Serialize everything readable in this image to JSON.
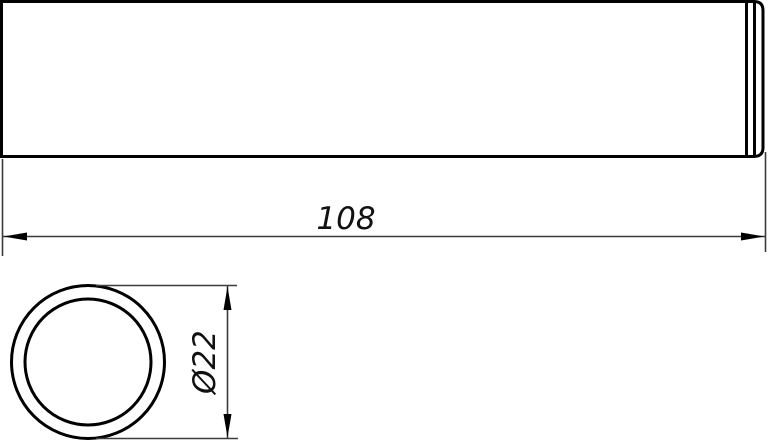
{
  "drawing": {
    "type": "technical-drawing",
    "background_color": "#ffffff",
    "outline_color": "#000000",
    "dimension_line_color": "#3c3c3c",
    "dimension_text_color": "#111111",
    "views": {
      "side_view": "cylindrical tube, side elevation with rounded right end and two edge lines near end",
      "front_view": "tube cross-section, two concentric circles"
    },
    "dimensions": {
      "length_label": "108",
      "diameter_label": "Ø22"
    }
  }
}
